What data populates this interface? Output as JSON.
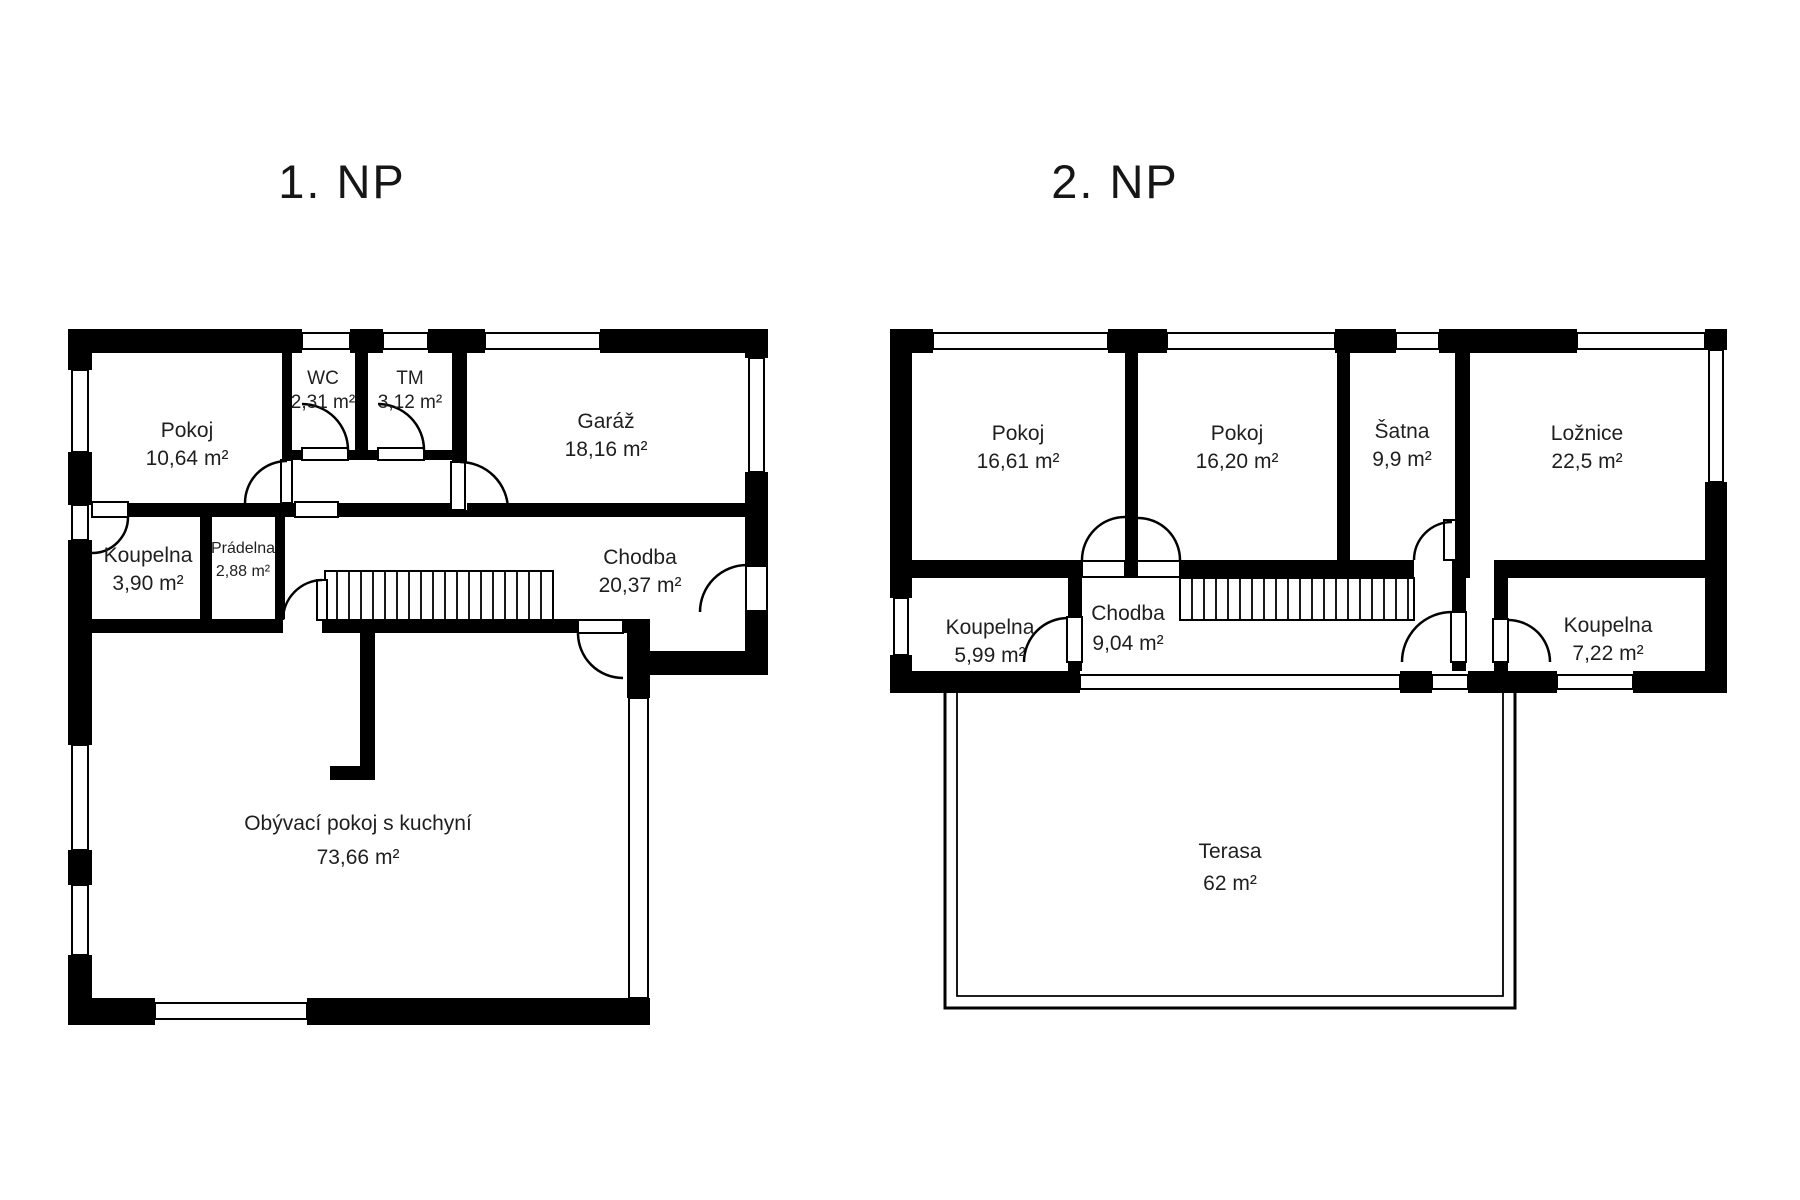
{
  "colors": {
    "wall": "#000000",
    "text": "#1f1f1f",
    "background": "#ffffff"
  },
  "floors": [
    {
      "title": "1. NP",
      "rooms": [
        {
          "name": "Pokoj",
          "area": "10,64 m²"
        },
        {
          "name": "WC",
          "area": "2,31 m²"
        },
        {
          "name": "TM",
          "area": "3,12 m²"
        },
        {
          "name": "Garáž",
          "area": "18,16 m²"
        },
        {
          "name": "Koupelna",
          "area": "3,90 m²"
        },
        {
          "name": "Prádelna",
          "area": "2,88 m²"
        },
        {
          "name": "Chodba",
          "area": "20,37 m²"
        },
        {
          "name": "Obývací pokoj s kuchyní",
          "area": "73,66 m²"
        }
      ]
    },
    {
      "title": "2. NP",
      "rooms": [
        {
          "name": "Pokoj",
          "area": "16,61 m²"
        },
        {
          "name": "Pokoj",
          "area": "16,20 m²"
        },
        {
          "name": "Šatna",
          "area": "9,9 m²"
        },
        {
          "name": "Ložnice",
          "area": "22,5 m²"
        },
        {
          "name": "Koupelna",
          "area": "5,99 m²"
        },
        {
          "name": "Chodba",
          "area": "9,04 m²"
        },
        {
          "name": "Koupelna",
          "area": "7,22 m²"
        },
        {
          "name": "Terasa",
          "area": "62 m²"
        }
      ]
    }
  ]
}
